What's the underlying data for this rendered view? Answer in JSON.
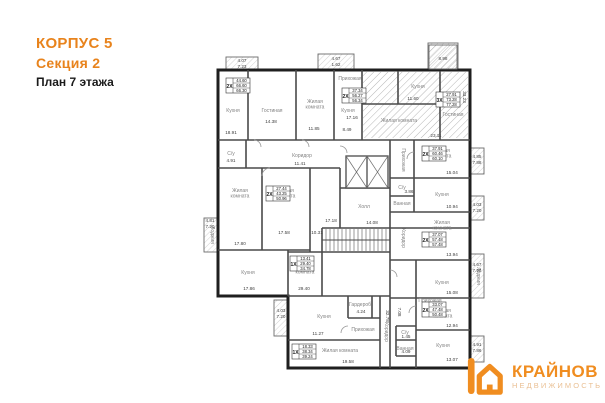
{
  "header": {
    "building": "КОРПУС 5",
    "section": "Секция 2",
    "floor": "План 7 этажа"
  },
  "logo": {
    "brand": "КРАЙНОВ",
    "subtitle": "НЕДВИЖИМОСТЬ"
  },
  "colors": {
    "accent_orange": "#E8831C",
    "logo_orange": "#F08D20",
    "logo_subtitle": "#EAC094",
    "outer_wall": "#1f1f1f",
    "inner_wall": "#4a4a4a",
    "hatch": "#9a9a9a",
    "room_label": "#828282",
    "dim_text": "#3c3c3c"
  },
  "plan": {
    "rooms": [
      {
        "label": "Кухня",
        "x": 233,
        "y": 112
      },
      {
        "label": "Гостиная",
        "x": 272,
        "y": 112
      },
      {
        "label": "Жилая",
        "l2": "комната",
        "x": 315,
        "y": 103
      },
      {
        "label": "Кухня",
        "x": 348,
        "y": 112
      },
      {
        "label": "Прихожая",
        "x": 350,
        "y": 80
      },
      {
        "label": "Кухня",
        "x": 418,
        "y": 88
      },
      {
        "label": "Жилая комната",
        "x": 399,
        "y": 122
      },
      {
        "label": "Гостиная",
        "x": 453,
        "y": 116
      },
      {
        "label": "Жилая",
        "l2": "комната",
        "x": 442,
        "y": 152
      },
      {
        "label": "Кухня",
        "x": 442,
        "y": 196
      },
      {
        "label": "Жилая",
        "l2": "комната",
        "x": 442,
        "y": 224
      },
      {
        "label": "Кухня",
        "x": 442,
        "y": 284
      },
      {
        "label": "Прихожая",
        "x": 402,
        "y": 160,
        "r": 90
      },
      {
        "label": "С/у",
        "x": 402,
        "y": 189
      },
      {
        "label": "Ванная",
        "x": 402,
        "y": 205
      },
      {
        "label": "Коридор",
        "x": 402,
        "y": 238,
        "r": 90
      },
      {
        "label": "Холл",
        "x": 364,
        "y": 208
      },
      {
        "label": "Коридор",
        "x": 302,
        "y": 157
      },
      {
        "label": "С/у",
        "x": 231,
        "y": 155
      },
      {
        "label": "Жилая",
        "l2": "комната",
        "x": 240,
        "y": 192
      },
      {
        "label": "Жилая",
        "l2": "комната",
        "x": 286,
        "y": 192
      },
      {
        "label": "Кухня",
        "x": 248,
        "y": 274
      },
      {
        "label": "Лоджия",
        "x": 211,
        "y": 235,
        "r": 90
      },
      {
        "label": "Жилая",
        "l2": "комната",
        "x": 305,
        "y": 268
      },
      {
        "label": "Кухня",
        "x": 324,
        "y": 318
      },
      {
        "label": "Гардероб",
        "x": 360,
        "y": 306
      },
      {
        "label": "Прихожая",
        "x": 363,
        "y": 331
      },
      {
        "label": "Жилая комната",
        "x": 340,
        "y": 352
      },
      {
        "label": "Коридор",
        "x": 385,
        "y": 332,
        "r": 90
      },
      {
        "label": "Жилая",
        "l2": "комната",
        "x": 443,
        "y": 312
      },
      {
        "label": "Кухня",
        "x": 443,
        "y": 347
      },
      {
        "label": "Ванная",
        "x": 405,
        "y": 350
      },
      {
        "label": "С/у",
        "x": 405,
        "y": 334
      },
      {
        "label": "Прихожая",
        "x": 430,
        "y": 302
      },
      {
        "label": "Лоджия",
        "x": 477,
        "y": 276,
        "r": 90
      }
    ],
    "stamps": [
      {
        "prefix": "2Х",
        "rows": [
          "44.60",
          "66.60",
          "66.30"
        ],
        "x": 226,
        "y": 78
      },
      {
        "prefix": "2Х",
        "rows": [
          "37.34",
          "56.27",
          "56.34"
        ],
        "x": 342,
        "y": 88
      },
      {
        "prefix": "3Х",
        "rows": [
          "27.91",
          "73.28",
          "77.28"
        ],
        "x": 436,
        "y": 92
      },
      {
        "prefix": "2Х",
        "rows": [
          "37.91",
          "60.46",
          "60.10"
        ],
        "x": 422,
        "y": 146
      },
      {
        "prefix": "2Х",
        "rows": [
          "37.07",
          "57.48",
          "57.48"
        ],
        "x": 422,
        "y": 232
      },
      {
        "prefix": "2Х",
        "rows": [
          "33.07",
          "47.48",
          "50.48"
        ],
        "x": 422,
        "y": 302
      },
      {
        "prefix": "1Х",
        "rows": [
          "18.33",
          "38.34",
          "39.24"
        ],
        "x": 292,
        "y": 344
      },
      {
        "prefix": "2Х",
        "rows": [
          "27.44",
          "43.25",
          "50.96"
        ],
        "x": 266,
        "y": 186
      },
      {
        "prefix": "1Х",
        "rows": [
          "13.41",
          "29.40",
          "34.78"
        ],
        "x": 290,
        "y": 256
      }
    ],
    "dims": [
      {
        "t": "18.91",
        "x": 231,
        "y": 134
      },
      {
        "t": "14.38",
        "x": 271,
        "y": 123
      },
      {
        "t": "11.85",
        "x": 314,
        "y": 130
      },
      {
        "t": "8.49",
        "x": 347,
        "y": 131
      },
      {
        "t": "17.16",
        "x": 352,
        "y": 119
      },
      {
        "t": "11.60",
        "x": 413,
        "y": 100
      },
      {
        "t": "23.11",
        "x": 436,
        "y": 137
      },
      {
        "t": "33.23",
        "x": 463,
        "y": 97,
        "r": 90
      },
      {
        "t": "11.41",
        "x": 300,
        "y": 165
      },
      {
        "t": "4.91",
        "x": 231,
        "y": 162
      },
      {
        "t": "17.80",
        "x": 240,
        "y": 245
      },
      {
        "t": "17.58",
        "x": 284,
        "y": 234
      },
      {
        "t": "10.31",
        "x": 317,
        "y": 234
      },
      {
        "t": "17.86",
        "x": 249,
        "y": 290
      },
      {
        "t": "14.08",
        "x": 372,
        "y": 224
      },
      {
        "t": "17.18",
        "x": 331,
        "y": 222
      },
      {
        "t": "15.04",
        "x": 452,
        "y": 174
      },
      {
        "t": "10.94",
        "x": 452,
        "y": 208
      },
      {
        "t": "13.94",
        "x": 452,
        "y": 256
      },
      {
        "t": "15.08",
        "x": 452,
        "y": 294
      },
      {
        "t": "12.94",
        "x": 452,
        "y": 327
      },
      {
        "t": "13.07",
        "x": 452,
        "y": 361
      },
      {
        "t": "4.09",
        "x": 406,
        "y": 353
      },
      {
        "t": "1.45",
        "x": 406,
        "y": 338
      },
      {
        "t": "7.08",
        "x": 398,
        "y": 312,
        "r": 90
      },
      {
        "t": "3.86",
        "x": 409,
        "y": 193
      },
      {
        "t": "11.27",
        "x": 318,
        "y": 335
      },
      {
        "t": "4.24",
        "x": 361,
        "y": 313
      },
      {
        "t": "19.58",
        "x": 348,
        "y": 363
      },
      {
        "t": "29.40",
        "x": 304,
        "y": 290
      },
      {
        "t": "32.78",
        "x": 386,
        "y": 316,
        "r": 90
      },
      {
        "t": "4.07",
        "x": 242,
        "y": 62
      },
      {
        "t": "7.23",
        "x": 242,
        "y": 68
      },
      {
        "t": "4.67",
        "x": 336,
        "y": 60
      },
      {
        "t": "1.62",
        "x": 336,
        "y": 66
      },
      {
        "t": "8.98",
        "x": 443,
        "y": 60
      },
      {
        "t": "4.85",
        "x": 477,
        "y": 158
      },
      {
        "t": "7.88",
        "x": 477,
        "y": 164
      },
      {
        "t": "4.03",
        "x": 477,
        "y": 206
      },
      {
        "t": "7.20",
        "x": 477,
        "y": 212
      },
      {
        "t": "4.67",
        "x": 477,
        "y": 266
      },
      {
        "t": "7.96",
        "x": 477,
        "y": 272
      },
      {
        "t": "4.91",
        "x": 477,
        "y": 346
      },
      {
        "t": "7.86",
        "x": 477,
        "y": 352
      },
      {
        "t": "4.81",
        "x": 210,
        "y": 222
      },
      {
        "t": "7.20",
        "x": 210,
        "y": 228
      },
      {
        "t": "4.03",
        "x": 281,
        "y": 312
      },
      {
        "t": "7.20",
        "x": 281,
        "y": 318
      }
    ]
  }
}
